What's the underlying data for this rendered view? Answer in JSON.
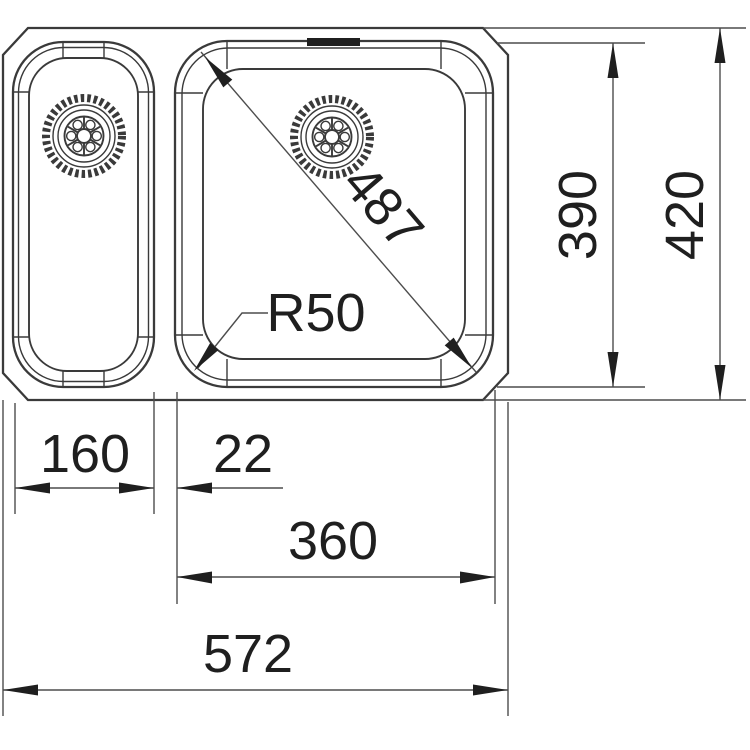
{
  "drawing": {
    "dimensions": {
      "left_bowl_width": "160",
      "bowl_gap": "22",
      "right_bowl_width": "360",
      "overall_width": "572",
      "bowl_front_to_back": "390",
      "overall_front_to_back": "420",
      "bowl_diagonal": "487",
      "corner_radius": "R50"
    },
    "colors": {
      "background": "#ffffff",
      "line_color": "#3a3a3a",
      "dim_color": "#4d4d4d",
      "text_color": "#1f1f1f"
    }
  }
}
